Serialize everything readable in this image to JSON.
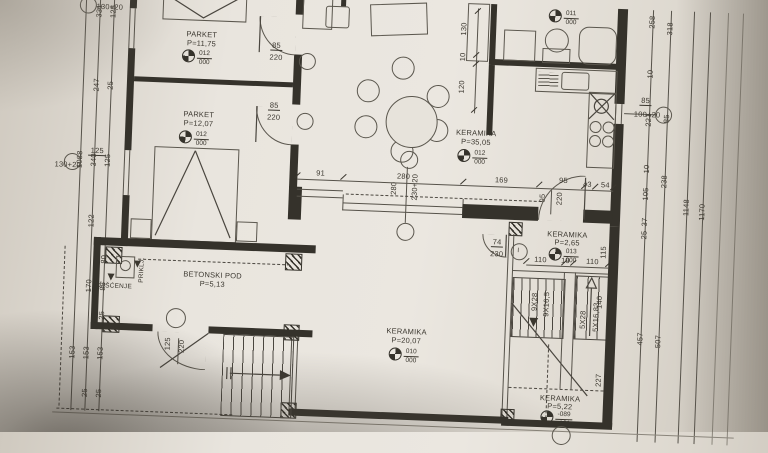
{
  "rooms": {
    "parket1": {
      "name": "PARKET",
      "area": "P=11,75"
    },
    "parket2": {
      "name": "PARKET",
      "area": "P=12,07"
    },
    "living": {
      "name": "KERAMIKA",
      "area": "P=35,05"
    },
    "wc": {
      "name": "KERAMIKA",
      "area": "P=2,65"
    },
    "hall": {
      "name": "KERAMIKA",
      "area": "P=20,07"
    },
    "entry": {
      "name": "KERAMIKA",
      "area": "P=5,22"
    },
    "terrace": {
      "name": "BETONSKI POD",
      "area": "P=5,13"
    }
  },
  "level_tags": {
    "bed1": {
      "top": "012",
      "bot": "000"
    },
    "bed2": {
      "top": "012",
      "bot": "000"
    },
    "living": {
      "top": "012",
      "bot": "000"
    },
    "bath": {
      "top": "011",
      "bot": "000"
    },
    "wc": {
      "top": "013",
      "bot": "000"
    },
    "hall": {
      "top": "010",
      "bot": "000"
    },
    "entry": {
      "top": "-089",
      "bot": "-101"
    }
  },
  "openings": {
    "door_bed1": {
      "w": "85",
      "h": "220"
    },
    "door_bed2": {
      "w": "85",
      "h": "220"
    },
    "door_kitchen": {
      "w": "95",
      "h": "220"
    },
    "door_wc": {
      "w": "74",
      "h": "230"
    },
    "door_terrace": {
      "w": "125",
      "h": "220"
    },
    "win_left1": {
      "w": "125",
      "h": "130+20"
    },
    "win_left2": {
      "w": "125",
      "h": "130+20"
    },
    "win_kitchen": {
      "w": "85",
      "h": "100+20"
    },
    "win_living": {
      "w": "280",
      "h": "230+20"
    }
  },
  "stairs": {
    "flight1_run": "9X28",
    "flight1_rise": "9X16,5",
    "flight2_run": "5X28",
    "flight2_rise": "5X16,83",
    "flight2_width": "140"
  },
  "misc": {
    "prikl": "PRIKLJ.",
    "ciscenje": "ČIŠĆENJE",
    "section_mark": "I"
  },
  "dims": {
    "main": [
      "91",
      "280",
      "169",
      "95",
      "43",
      "54"
    ],
    "wc_row": [
      "110",
      "10",
      "110"
    ],
    "wc_side": "115",
    "stair_side": "227",
    "bath": [
      "130",
      "10",
      "120"
    ],
    "left": [
      "125",
      "331",
      "247",
      "25",
      "1088",
      "125",
      "340",
      "122",
      "25",
      "80",
      "170",
      "85",
      "25",
      "153",
      "153",
      "153",
      "25",
      "25"
    ],
    "right": [
      "258",
      "318",
      "10",
      "221",
      "85",
      "10",
      "238",
      "105",
      "1148",
      "1170",
      "37",
      "25",
      "457",
      "507"
    ]
  },
  "colors": {
    "paper": "#e9e5de",
    "line": "#56524a",
    "wall": "#35322b",
    "text": "#3b372f"
  }
}
